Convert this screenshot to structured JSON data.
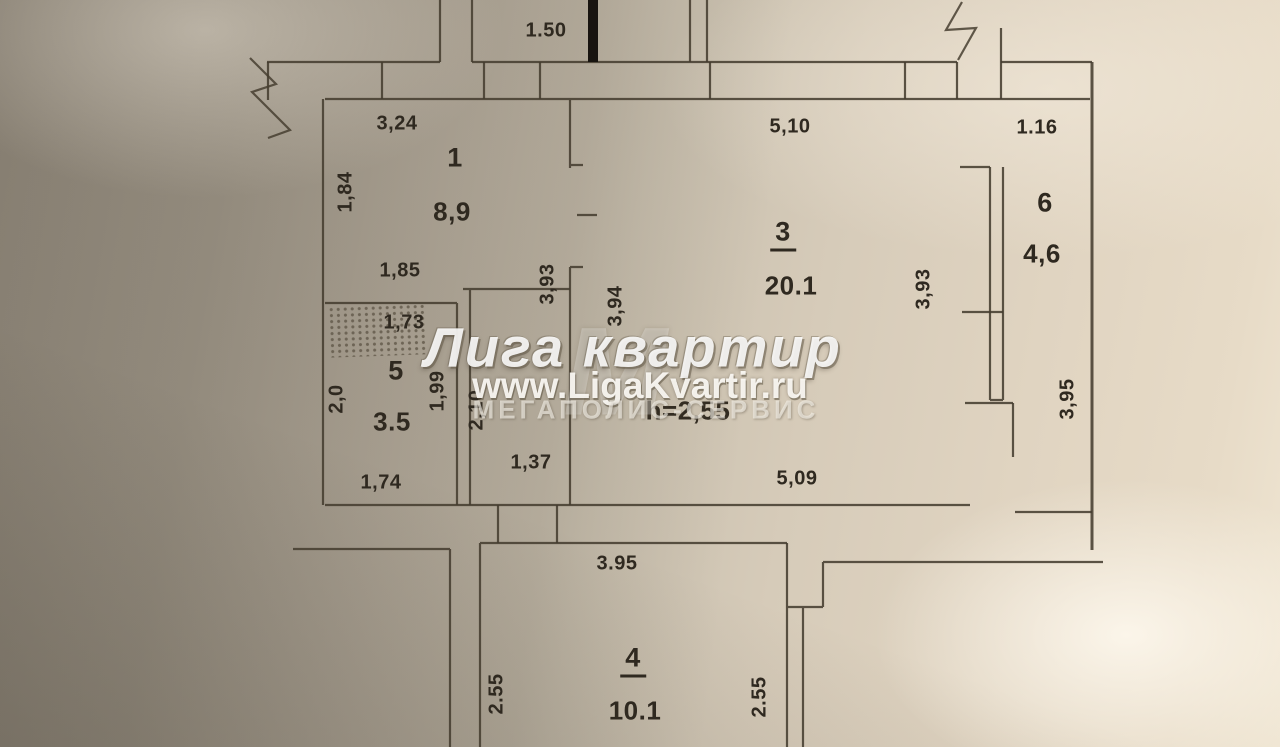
{
  "floorplan": {
    "rooms": [
      {
        "number": "1",
        "area": "8,9",
        "underline": false,
        "nx": 455,
        "ny": 158,
        "ax": 452,
        "ay": 212
      },
      {
        "number": "3",
        "area": "20.1",
        "underline": true,
        "nx": 783,
        "ny": 234,
        "ax": 791,
        "ay": 286
      },
      {
        "number": "4",
        "area": "10.1",
        "underline": true,
        "nx": 633,
        "ny": 660,
        "ax": 635,
        "ay": 711
      },
      {
        "number": "5",
        "area": "3.5",
        "underline": false,
        "nx": 396,
        "ny": 371,
        "ax": 392,
        "ay": 422
      },
      {
        "number": "6",
        "area": "4,6",
        "underline": false,
        "nx": 1045,
        "ny": 203,
        "ax": 1042,
        "ay": 254
      }
    ],
    "ceiling_height_label": "h=2,55",
    "ceiling_height_pos": {
      "x": 688,
      "y": 411
    },
    "dimensions": [
      {
        "text": "1.50",
        "x": 546,
        "y": 31,
        "vert": false
      },
      {
        "text": "3,24",
        "x": 397,
        "y": 124,
        "vert": false
      },
      {
        "text": "5,10",
        "x": 790,
        "y": 127,
        "vert": false
      },
      {
        "text": "1.16",
        "x": 1037,
        "y": 128,
        "vert": false
      },
      {
        "text": "1,84",
        "x": 346,
        "y": 192,
        "vert": true
      },
      {
        "text": "1,85",
        "x": 400,
        "y": 271,
        "vert": false
      },
      {
        "text": "1,73",
        "x": 404,
        "y": 323,
        "vert": false
      },
      {
        "text": "2,0",
        "x": 337,
        "y": 399,
        "vert": true
      },
      {
        "text": "1,99",
        "x": 438,
        "y": 391,
        "vert": true
      },
      {
        "text": "2,10",
        "x": 477,
        "y": 410,
        "vert": true
      },
      {
        "text": "3,93",
        "x": 548,
        "y": 284,
        "vert": true
      },
      {
        "text": "3,94",
        "x": 616,
        "y": 306,
        "vert": true
      },
      {
        "text": "3,93",
        "x": 924,
        "y": 289,
        "vert": true
      },
      {
        "text": "3,95",
        "x": 1068,
        "y": 399,
        "vert": true
      },
      {
        "text": "1,37",
        "x": 531,
        "y": 463,
        "vert": false
      },
      {
        "text": "1,74",
        "x": 381,
        "y": 483,
        "vert": false
      },
      {
        "text": "5,09",
        "x": 797,
        "y": 479,
        "vert": false
      },
      {
        "text": "3.95",
        "x": 617,
        "y": 564,
        "vert": false
      },
      {
        "text": "2.55",
        "x": 497,
        "y": 694,
        "vert": true
      },
      {
        "text": "2.55",
        "x": 760,
        "y": 697,
        "vert": true
      }
    ]
  },
  "watermark": {
    "logo_letter": "М",
    "title": "Лига квартир",
    "url": "www.LigaKvartir.ru",
    "subtitle": "МЕГАПОЛИС-СЕРВИС"
  },
  "colors": {
    "ink": "#463e30",
    "text": "#2f2920",
    "entrance_mark": "#181410"
  }
}
